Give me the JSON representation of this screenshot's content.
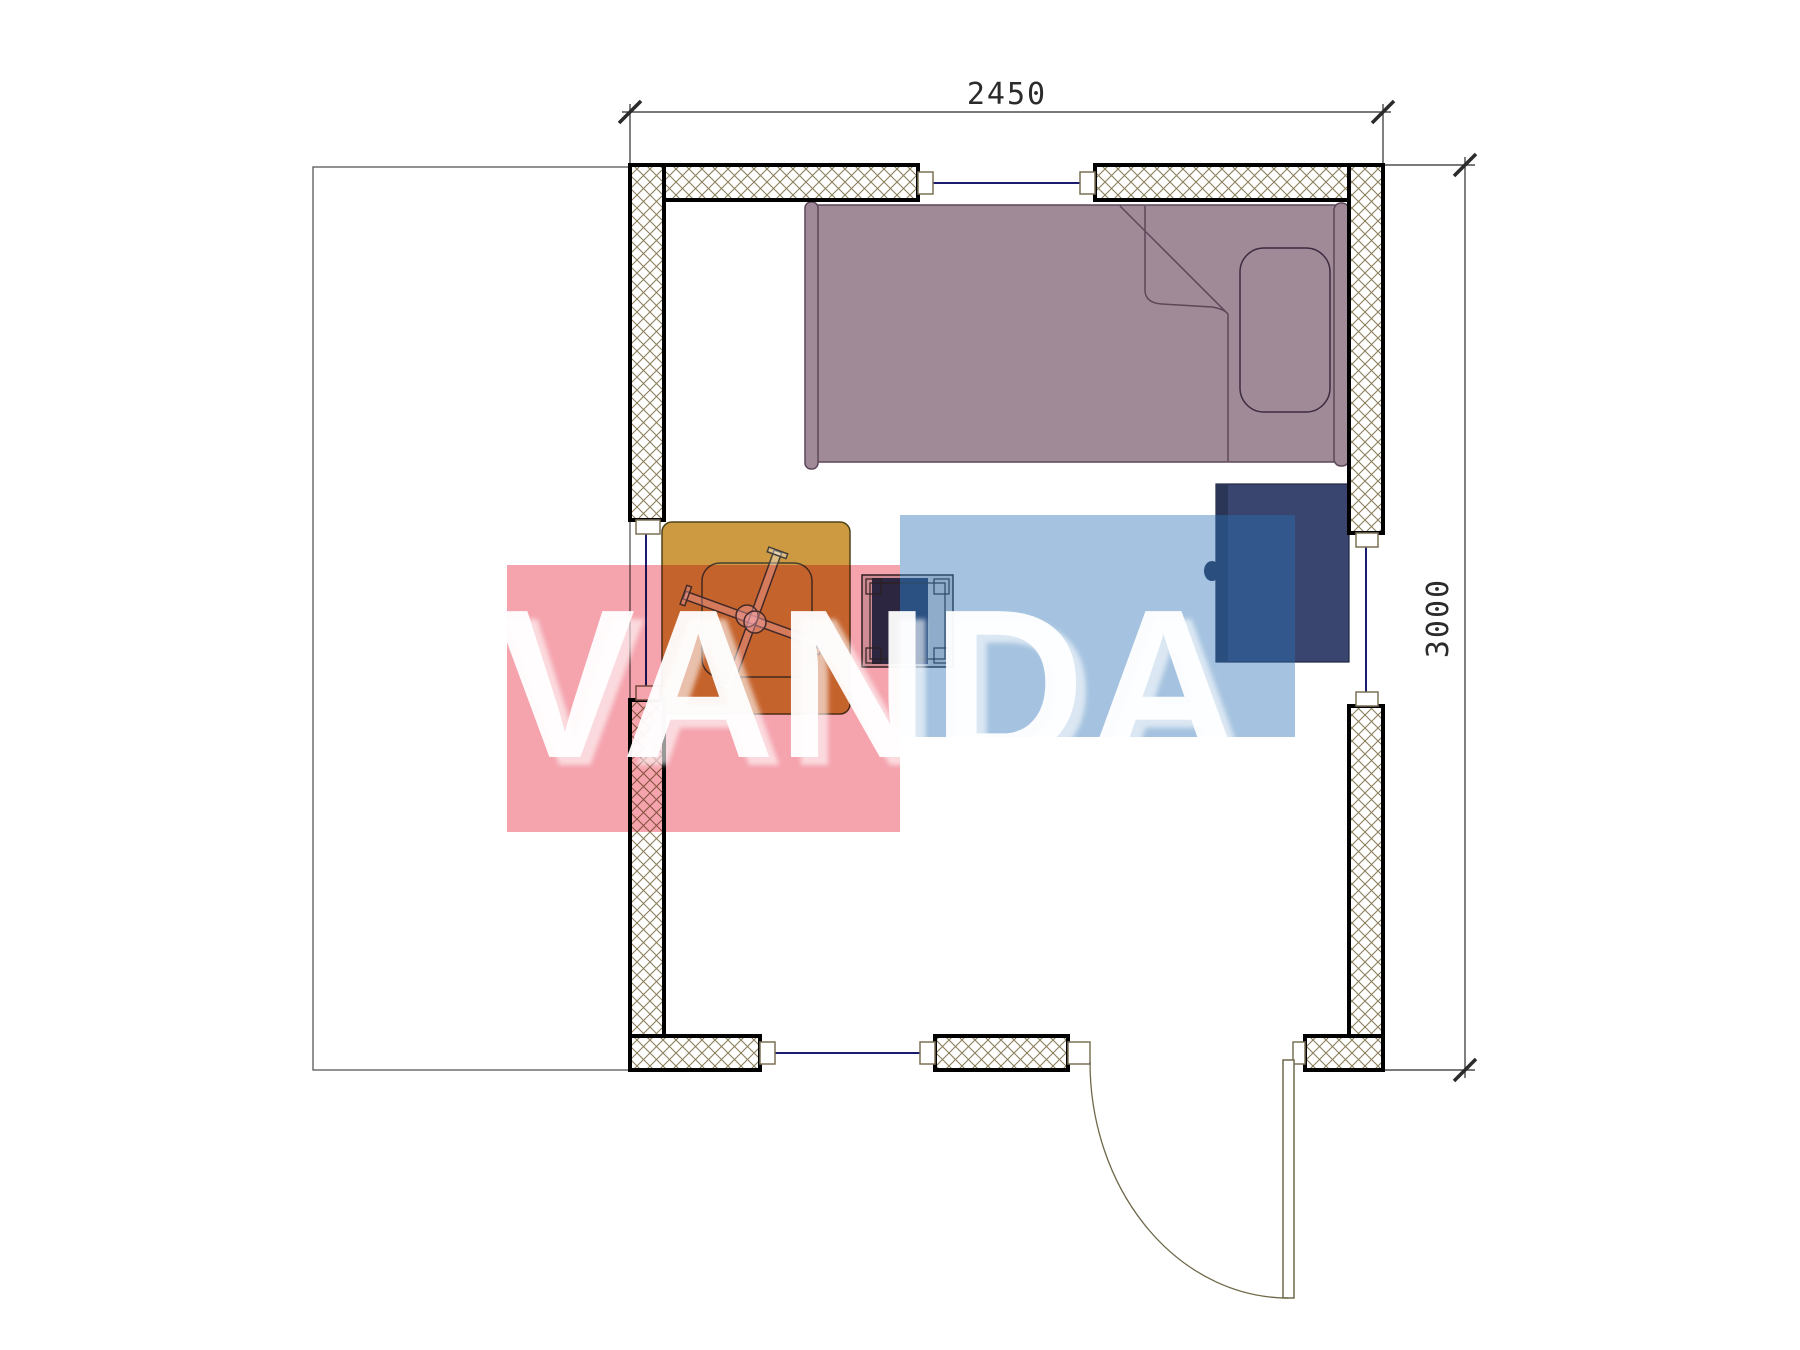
{
  "title": "Floor plan with furniture (bed, table, stool, cabinet), watermarked",
  "dimensions": {
    "width_mm": "2450",
    "height_mm": "3000"
  },
  "watermark": {
    "text": "VANDA",
    "red": "#f5a4ae",
    "blue": "#2870b6",
    "blue_opacity": "0.42"
  },
  "colors": {
    "bed": "#a18a98",
    "bed_outline": "#5c4758",
    "table": "#cd9a41",
    "table_outline": "#4e431c",
    "cabinet": "#39456f",
    "cabinet_dark": "#2b3657",
    "stool_fill": "#d9d9d9",
    "stool_insert": "#2e3a5e",
    "hatch": "#8b7f5b",
    "wall_border": "#000000",
    "window_glass": "#1b1b70",
    "frame_stroke": "#7a7155",
    "door_stroke": "#6f684a",
    "dim_lines": "#2b2b2b",
    "terrace_line": "#4a4a4a"
  }
}
